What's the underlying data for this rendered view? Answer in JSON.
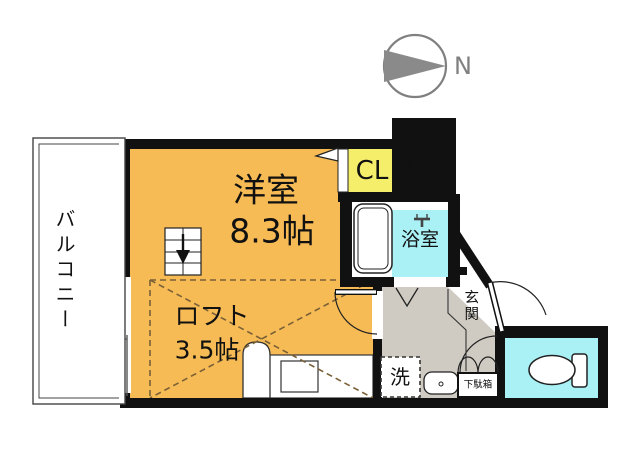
{
  "colors": {
    "room_orange": "#F6BB55",
    "closet_yellow": "#F5EE6A",
    "ps_gray": "#D2CEC5",
    "hall_gray": "#CFCBC2",
    "water_cyan": "#A9F1F4",
    "wall_black": "#111111",
    "compass_gray": "#808080",
    "loft_dash": "#7a6036"
  },
  "compass": {
    "north_label": "N"
  },
  "rooms": {
    "balcony": {
      "label": "バルコニー"
    },
    "main_room": {
      "name": "洋室",
      "size": "8.3帖"
    },
    "loft": {
      "name": "ロフト",
      "size": "3.5帖"
    },
    "closet": {
      "label": "CL"
    },
    "pipe_space": {
      "label": "PS"
    },
    "bathroom": {
      "label": "浴室"
    },
    "entrance": {
      "label": "玄関"
    },
    "washer": {
      "label": "洗"
    },
    "shoe_cabinet": {
      "label": "下駄箱"
    }
  }
}
